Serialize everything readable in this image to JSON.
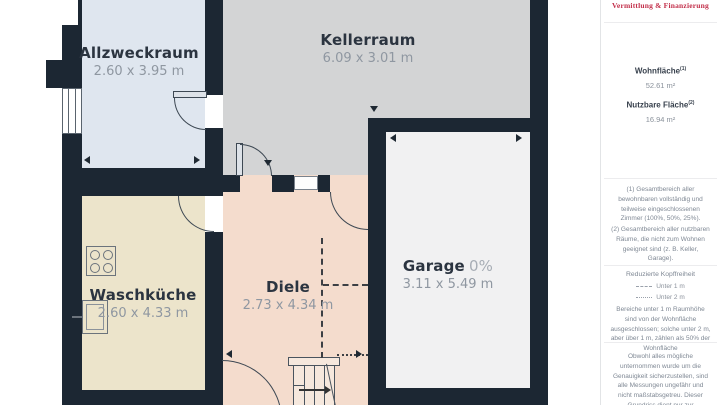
{
  "plan": {
    "wall_color": "#1c2733",
    "rooms": [
      {
        "name": "Allzweckraum",
        "dims": "2.60 x 3.95 m",
        "fill": "#dfe6ef"
      },
      {
        "name": "Kellerraum",
        "dims": "6.09 x 3.01 m",
        "fill": "#d3d4d5"
      },
      {
        "name": "Waschküche",
        "dims": "2.60 x 4.33 m",
        "fill": "#ece4cb"
      },
      {
        "name": "Diele",
        "dims": "2.73 x 4.34 m",
        "fill": "#f4dccd"
      },
      {
        "name": "Garage",
        "area_share": "0%",
        "dims": "3.11 x 5.49 m",
        "fill": "#f1f1f2"
      }
    ],
    "symbols": [
      "window",
      "door-swing",
      "cooktop",
      "sink",
      "staircase",
      "dimension-arrows",
      "headroom-dashed-lines"
    ]
  },
  "sidebar": {
    "brand_tagline": "Vermittlung & Finanzierung",
    "brand_color": "#c22f4a",
    "metrics": [
      {
        "label": "Wohnfläche",
        "footnote_ref": "(1)",
        "value": "52.61 m²"
      },
      {
        "label": "Nutzbare Fläche",
        "footnote_ref": "(2)",
        "value": "16.94 m²"
      }
    ],
    "footnotes": [
      "(1) Gesamtbereich aller bewohnbaren vollständig und teilweise eingeschlossenen Zimmer (100%, 50%, 25%).",
      "(2) Gesamtbereich aller nutzbaren Räume, die nicht zum Wohnen geeignet sind (z. B. Keller, Garage)."
    ],
    "headroom": {
      "title": "Reduzierte Kopffreiheit",
      "legend": [
        {
          "label": "Unter 1 m",
          "line_style": "dashed"
        },
        {
          "label": "Unter 2 m",
          "line_style": "dotted"
        }
      ],
      "note": "Bereiche unter 1 m Raumhöhe sind von der Wohnfläche ausgeschlossen; solche unter 2 m, aber über 1 m, zählen als 50% der Wohnfläche"
    },
    "disclaimer": "Obwohl alles mögliche unternommen wurde um die Genauigkeit sicherzustellen, sind alle Messungen ungefähr und nicht maßstabsgetreu. Dieser Grundriss dient nur zur Veranschaulichung."
  }
}
